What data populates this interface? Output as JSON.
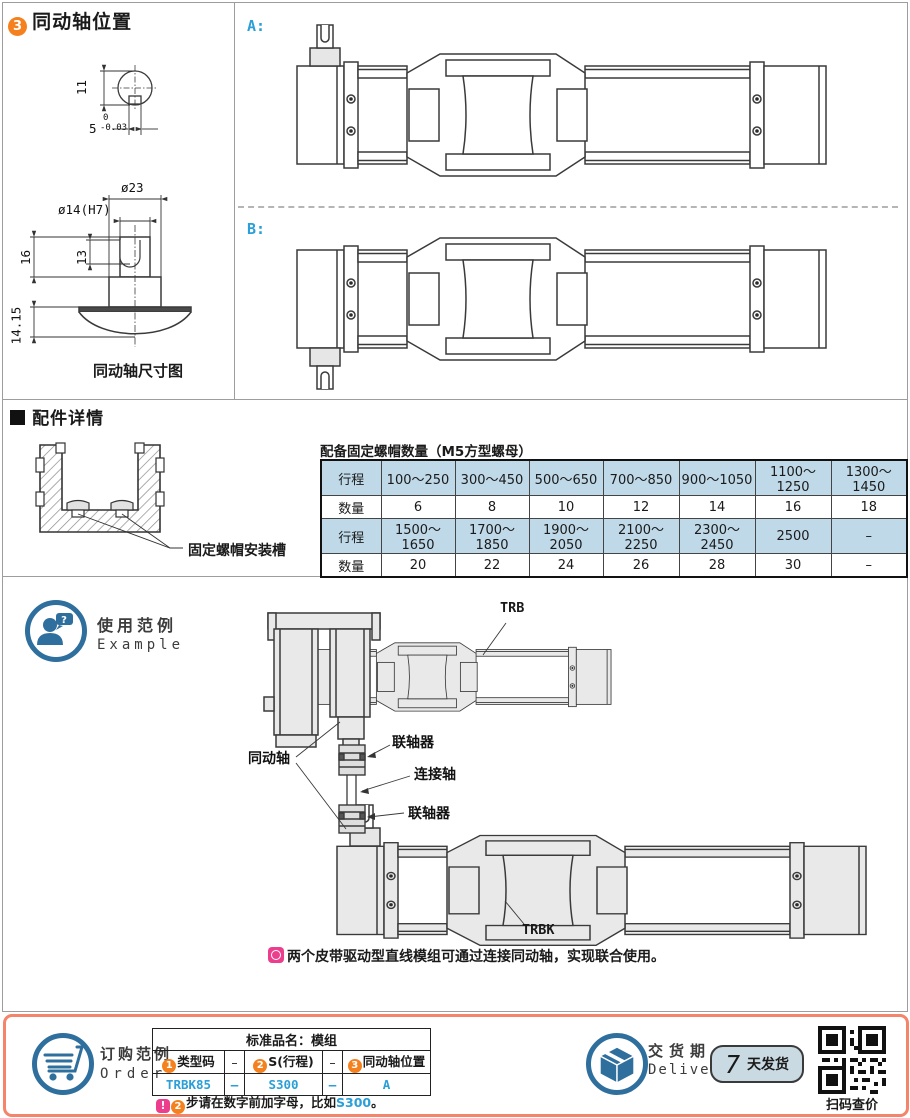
{
  "colors": {
    "accent_orange": "#f5811e",
    "accent_blue_text": "#2a9fd8",
    "icon_blue": "#2f6f9d",
    "table_header_blue": "#bfd9e8",
    "bottom_border_salmon": "#f4846a",
    "note_pink": "#ec3e8d",
    "drawing_fill_gray": "#e9e9e9"
  },
  "sec_position": {
    "badge": "3",
    "title": "同动轴位置",
    "label_a": "A:",
    "label_b": "B:",
    "dims": {
      "d11": "11",
      "d5": "5",
      "tol_top": "0",
      "tol_bot": "-0.03",
      "dia23": "ø23",
      "dia14": "ø14(H7)",
      "d16": "16",
      "d13": "13",
      "d1415": "14.15",
      "caption": "同动轴尺寸图"
    }
  },
  "sec_acc": {
    "title": "配件详情",
    "slot_label": "固定螺帽安装槽",
    "table_title": "配备固定螺帽数量（M5方型螺母）",
    "hdr_stroke": "行程",
    "hdr_qty": "数量",
    "strokes1": [
      "100～250",
      "300～450",
      "500～650",
      "700～850",
      "900～1050",
      "1100～1250",
      "1300～1450"
    ],
    "qty1": [
      "6",
      "8",
      "10",
      "12",
      "14",
      "16",
      "18"
    ],
    "strokes2": [
      "1500～1650",
      "1700～1850",
      "1900～2050",
      "2100～2250",
      "2300～2450",
      "2500",
      "–"
    ],
    "qty2": [
      "20",
      "22",
      "24",
      "26",
      "28",
      "30",
      "–"
    ]
  },
  "sec_example": {
    "title_cn": "使用范例",
    "title_en": "Example",
    "lbl_trb": "TRB",
    "lbl_trbk": "TRBK",
    "lbl_coupling_top": "联轴器",
    "lbl_coupling_bottom": "联轴器",
    "lbl_connect_shaft": "连接轴",
    "lbl_sync_shaft": "同动轴",
    "note": "两个皮带驱动型直线模组可通过连接同动轴，实现联合使用。"
  },
  "sec_order": {
    "title_cn": "订购范例",
    "title_en": "Order",
    "table_title": "标准品名：模组",
    "c1_badge": "1",
    "c1": "类型码",
    "c2_badge": "2",
    "c2": "S(行程)",
    "c3_badge": "3",
    "c3": "同动轴位置",
    "sep1": "–",
    "sep2": "–",
    "v1": "TRBK85",
    "v2": "S300",
    "v3": "A",
    "vsep1": "–",
    "vsep2": "–",
    "note_excl": "!",
    "note_badge": "2",
    "note_text": "步请在数字前加字母，比如",
    "note_code": "S300",
    "note_period": "。"
  },
  "sec_delivery": {
    "title_cn": "交货期",
    "title_en": "Delivery",
    "days": "7",
    "days_suffix": "天发货",
    "qr_caption": "扫码查价"
  }
}
